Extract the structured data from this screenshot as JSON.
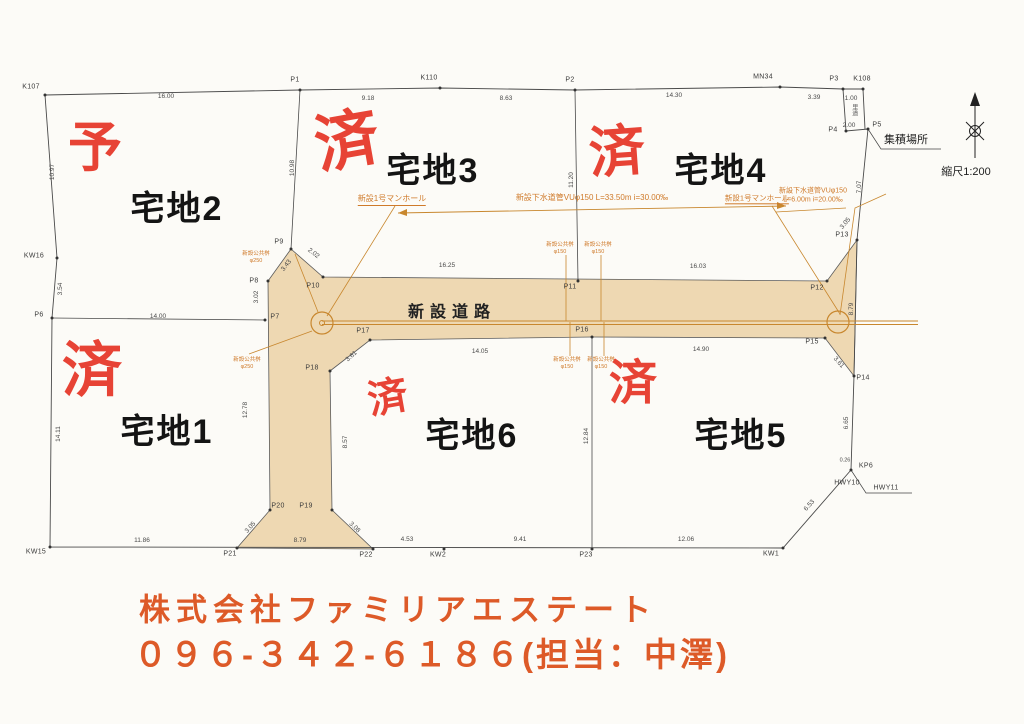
{
  "colors": {
    "stamp_red": "#e63a2b",
    "footer_orange": "#dd5a28",
    "pipe_orange": "#cf7a2a",
    "road_fill": "#eed8b2",
    "line_dark": "#4a4a4a"
  },
  "drawing": {
    "road_label": "新設道路",
    "scale_label": "縮尺1:200",
    "facility_label": "集積場所",
    "lots": [
      {
        "t": "宅地1",
        "x": 167,
        "y": 432
      },
      {
        "t": "宅地2",
        "x": 177,
        "y": 209
      },
      {
        "t": "宅地3",
        "x": 433,
        "y": 171
      },
      {
        "t": "宅地4",
        "x": 721,
        "y": 171
      },
      {
        "t": "宅地5",
        "x": 741,
        "y": 436
      },
      {
        "t": "宅地6",
        "x": 472,
        "y": 436
      }
    ],
    "stamps": [
      {
        "t": "予",
        "x": 95,
        "y": 148,
        "s": 54,
        "r": 0
      },
      {
        "t": "済",
        "x": 347,
        "y": 141,
        "s": 64,
        "r": -10
      },
      {
        "t": "済",
        "x": 617,
        "y": 152,
        "s": 56,
        "r": -4
      },
      {
        "t": "済",
        "x": 92,
        "y": 371,
        "s": 60,
        "r": 0
      },
      {
        "t": "済",
        "x": 388,
        "y": 398,
        "s": 40,
        "r": -10
      },
      {
        "t": "済",
        "x": 633,
        "y": 384,
        "s": 48,
        "r": 0
      }
    ],
    "points": [
      {
        "label": "K107",
        "lx": 31,
        "ly": 87,
        "mx": 45,
        "my": 95
      },
      {
        "label": "P1",
        "lx": 295,
        "ly": 80,
        "mx": 300,
        "my": 90
      },
      {
        "label": "K110",
        "lx": 429,
        "ly": 78,
        "mx": 440,
        "my": 88
      },
      {
        "label": "P2",
        "lx": 570,
        "ly": 80,
        "mx": 575,
        "my": 90
      },
      {
        "label": "MN34",
        "lx": 763,
        "ly": 77,
        "mx": 780,
        "my": 87
      },
      {
        "label": "P3",
        "lx": 834,
        "ly": 79,
        "mx": 843,
        "my": 89
      },
      {
        "label": "K108",
        "lx": 862,
        "ly": 79,
        "mx": 863,
        "my": 89
      },
      {
        "label": "P4",
        "lx": 833,
        "ly": 130,
        "mx": 846,
        "my": 131
      },
      {
        "label": "P5",
        "lx": 877,
        "ly": 125,
        "mx": 868,
        "my": 129
      },
      {
        "label": "P13",
        "lx": 842,
        "ly": 235,
        "mx": 857,
        "my": 240
      },
      {
        "label": "P12",
        "lx": 817,
        "ly": 288,
        "mx": 827,
        "my": 281
      },
      {
        "label": "P15",
        "lx": 812,
        "ly": 342,
        "mx": 825,
        "my": 338
      },
      {
        "label": "P14",
        "lx": 863,
        "ly": 378,
        "mx": 854,
        "my": 376
      },
      {
        "label": "KP6",
        "lx": 866,
        "ly": 466,
        "mx": 851,
        "my": 470
      },
      {
        "label": "HWY10",
        "lx": 847,
        "ly": 483
      },
      {
        "label": "HWY11",
        "lx": 886,
        "ly": 488
      },
      {
        "label": "KW1",
        "lx": 771,
        "ly": 554,
        "mx": 783,
        "my": 548
      },
      {
        "label": "P23",
        "lx": 586,
        "ly": 555,
        "mx": 592,
        "my": 549
      },
      {
        "label": "KW2",
        "lx": 438,
        "ly": 555,
        "mx": 444,
        "my": 549
      },
      {
        "label": "P22",
        "lx": 366,
        "ly": 555,
        "mx": 373,
        "my": 549
      },
      {
        "label": "P21",
        "lx": 230,
        "ly": 554,
        "mx": 237,
        "my": 548
      },
      {
        "label": "KW15",
        "lx": 36,
        "ly": 552,
        "mx": 50,
        "my": 547
      },
      {
        "label": "P6",
        "lx": 39,
        "ly": 315,
        "mx": 52,
        "my": 318
      },
      {
        "label": "KW16",
        "lx": 34,
        "ly": 256,
        "mx": 57,
        "my": 258
      },
      {
        "label": "P7",
        "lx": 275,
        "ly": 317,
        "mx": 265,
        "my": 320
      },
      {
        "label": "P8",
        "lx": 254,
        "ly": 281,
        "mx": 268,
        "my": 281
      },
      {
        "label": "P9",
        "lx": 279,
        "ly": 242,
        "mx": 291,
        "my": 249
      },
      {
        "label": "P10",
        "lx": 313,
        "ly": 286,
        "mx": 323,
        "my": 277
      },
      {
        "label": "P11",
        "lx": 570,
        "ly": 287,
        "mx": 578,
        "my": 281
      },
      {
        "label": "P16",
        "lx": 582,
        "ly": 330,
        "mx": 592,
        "my": 337
      },
      {
        "label": "P17",
        "lx": 363,
        "ly": 331,
        "mx": 370,
        "my": 340
      },
      {
        "label": "P18",
        "lx": 312,
        "ly": 368,
        "mx": 330,
        "my": 371
      },
      {
        "label": "P19",
        "lx": 306,
        "ly": 506,
        "mx": 332,
        "my": 510
      },
      {
        "label": "P20",
        "lx": 278,
        "ly": 506,
        "mx": 270,
        "my": 510
      }
    ],
    "dims": [
      {
        "t": "16.00",
        "x": 166,
        "y": 97
      },
      {
        "t": "9.18",
        "x": 368,
        "y": 99
      },
      {
        "t": "8.63",
        "x": 506,
        "y": 99
      },
      {
        "t": "14.30",
        "x": 674,
        "y": 96
      },
      {
        "t": "3.39",
        "x": 814,
        "y": 98
      },
      {
        "t": "1.00",
        "x": 851,
        "y": 99
      },
      {
        "t": "2.00",
        "x": 849,
        "y": 126
      },
      {
        "t": "10.97",
        "x": 53,
        "y": 172,
        "r": -90
      },
      {
        "t": "3.54",
        "x": 61,
        "y": 289,
        "r": -90
      },
      {
        "t": "14.11",
        "x": 59,
        "y": 434,
        "r": -90
      },
      {
        "t": "10.98",
        "x": 293,
        "y": 168,
        "r": -90
      },
      {
        "t": "11.20",
        "x": 572,
        "y": 180,
        "r": -90
      },
      {
        "t": "12.84",
        "x": 587,
        "y": 436,
        "r": -90
      },
      {
        "t": "12.78",
        "x": 246,
        "y": 410,
        "r": -90
      },
      {
        "t": "8.57",
        "x": 346,
        "y": 442,
        "r": -90
      },
      {
        "t": "7.07",
        "x": 860,
        "y": 187,
        "r": -90
      },
      {
        "t": "8.79",
        "x": 852,
        "y": 309,
        "r": -90
      },
      {
        "t": "6.65",
        "x": 847,
        "y": 423,
        "r": -90
      },
      {
        "t": "6.53",
        "x": 810,
        "y": 506,
        "r": -49
      },
      {
        "t": "14.00",
        "x": 158,
        "y": 317
      },
      {
        "t": "16.25",
        "x": 447,
        "y": 266
      },
      {
        "t": "16.03",
        "x": 698,
        "y": 267
      },
      {
        "t": "14.05",
        "x": 480,
        "y": 352
      },
      {
        "t": "14.90",
        "x": 701,
        "y": 350
      },
      {
        "t": "3.43",
        "x": 287,
        "y": 266,
        "r": -52
      },
      {
        "t": "2.02",
        "x": 313,
        "y": 254,
        "r": 38
      },
      {
        "t": "3.02",
        "x": 257,
        "y": 297,
        "r": -90
      },
      {
        "t": "3.61",
        "x": 352,
        "y": 357,
        "r": -42
      },
      {
        "t": "3.05",
        "x": 846,
        "y": 224,
        "r": -50
      },
      {
        "t": "3.61",
        "x": 838,
        "y": 363,
        "r": 48
      },
      {
        "t": "3.05",
        "x": 251,
        "y": 528,
        "r": -48
      },
      {
        "t": "3.08",
        "x": 354,
        "y": 528,
        "r": 44
      },
      {
        "t": "11.86",
        "x": 142,
        "y": 541
      },
      {
        "t": "8.79",
        "x": 300,
        "y": 541
      },
      {
        "t": "4.53",
        "x": 407,
        "y": 540
      },
      {
        "t": "9.41",
        "x": 520,
        "y": 540
      },
      {
        "t": "12.06",
        "x": 686,
        "y": 540
      },
      {
        "t": "0.26",
        "x": 845,
        "y": 461,
        "s": 5.5
      }
    ],
    "notes": [
      {
        "t": "新設1号マンホール",
        "x": 392,
        "y": 200,
        "s": 8,
        "u": true
      },
      {
        "t": "新設下水道管VUφ150 L=33.50m i=30.00‰",
        "x": 592,
        "y": 198,
        "s": 8
      },
      {
        "t": "新設1号マンホール",
        "x": 757,
        "y": 199,
        "s": 7.5,
        "u": true
      },
      {
        "t": "新設下水道管VUφ150\nL=6.00m i=20.00‰",
        "x": 813,
        "y": 196,
        "s": 7
      },
      {
        "t": "新設公共桝\nφ250",
        "x": 256,
        "y": 258,
        "s": 5.5
      },
      {
        "t": "新設公共桝\nφ250",
        "x": 247,
        "y": 364,
        "s": 5.5
      },
      {
        "t": "新設公共桝\nφ150",
        "x": 560,
        "y": 249,
        "s": 5.5
      },
      {
        "t": "新設公共桝\nφ150",
        "x": 598,
        "y": 249,
        "s": 5.5
      },
      {
        "t": "新設公共桝\nφ150",
        "x": 567,
        "y": 364,
        "s": 5.5
      },
      {
        "t": "新設公共桝\nφ150",
        "x": 601,
        "y": 364,
        "s": 5.5
      },
      {
        "t": "里道",
        "x": 853,
        "y": 110,
        "s": 6,
        "vert": true
      }
    ]
  },
  "footer": {
    "company": "株式会社ファミリアエステート",
    "phone": "０９６-３４２-６１８６(担当：中澤)"
  }
}
